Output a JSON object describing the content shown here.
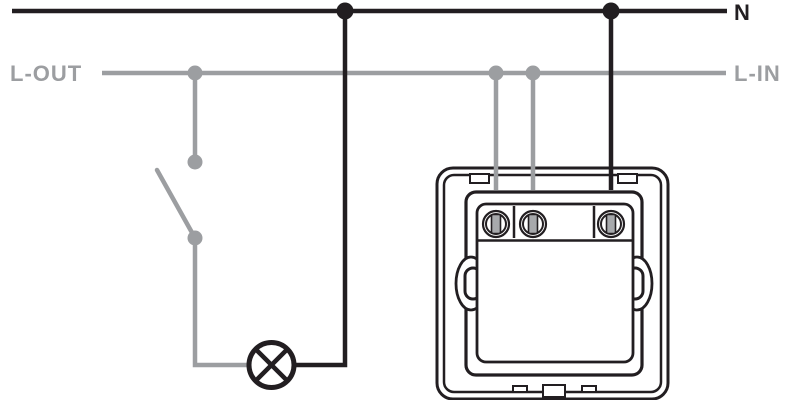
{
  "diagram": {
    "labels": {
      "neutral": "N",
      "l_out": "L-OUT",
      "l_in": "L-IN"
    },
    "symbols": {
      "switch": "single-pole-switch-open",
      "lamp": "lamp-circle-cross",
      "device": "flush-mount-switch-rear-view",
      "terminal_count": "3"
    }
  },
  "colors": {
    "neutral_black": "#221e21",
    "live_gray": "#9c9ea1",
    "screw_fill": "#a7a9ac",
    "background": "#ffffff"
  }
}
